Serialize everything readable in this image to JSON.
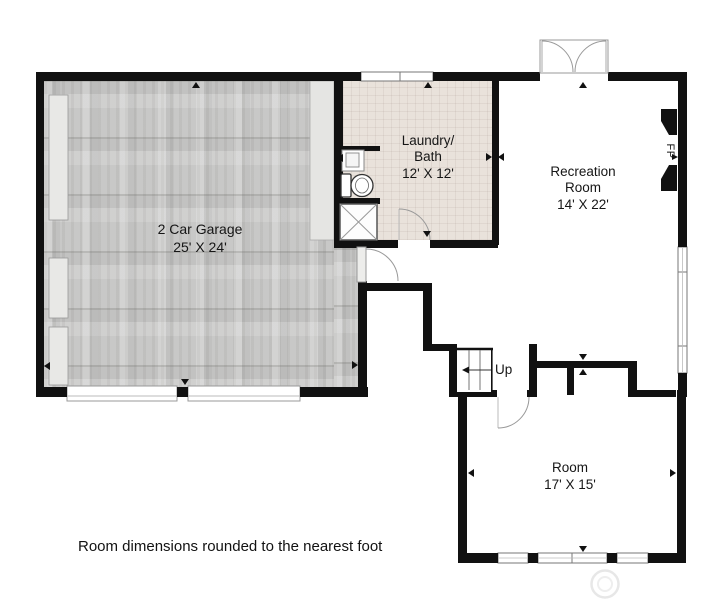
{
  "rooms": {
    "garage": {
      "lines": [
        "2 Car Garage"
      ],
      "dimensions": "25' X 24'"
    },
    "laundry": {
      "lines": [
        "Laundry/",
        "Bath"
      ],
      "dimensions": "12' X 12'"
    },
    "recreation": {
      "lines": [
        "Recreation",
        "Room"
      ],
      "dimensions": "14' X 22'"
    },
    "room": {
      "lines": [
        "Room"
      ],
      "dimensions": "17' X 15'"
    }
  },
  "stairs": {
    "label": "Up"
  },
  "fireplace": {
    "label": "FP"
  },
  "footer": {
    "note": "Room dimensions rounded to the nearest foot"
  },
  "colors": {
    "wall": "#111111",
    "garage_floor": "#cccccb",
    "laundry_floor": "#e9e2db"
  }
}
